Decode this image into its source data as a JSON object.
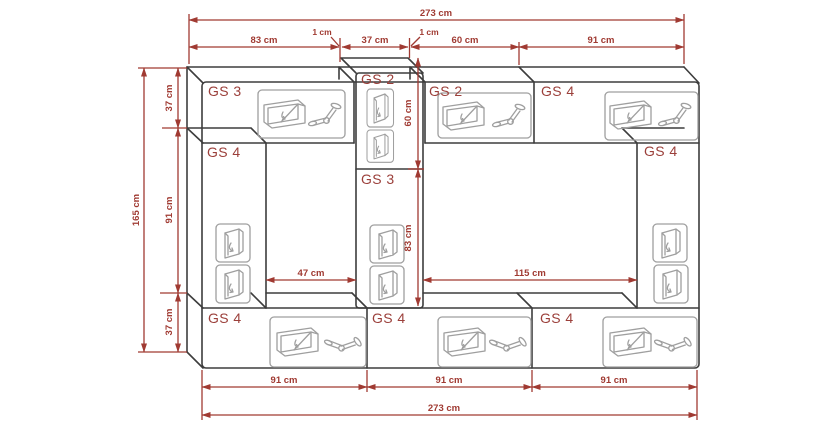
{
  "diagram": {
    "background": "#ffffff",
    "colors": {
      "outline": "#3d3d3d",
      "icon_line": "#9f9f9f",
      "dimension": "#a03a32",
      "label_text": "#9b3f3a"
    },
    "modules": {
      "top_left": "GS 3",
      "column_top": "GS 2",
      "top_middle": "GS 2",
      "top_right": "GS 4",
      "left_column": "GS 4",
      "column_middle": "GS 3",
      "right_column": "GS 4",
      "bottom_left": "GS 4",
      "bottom_middle": "GS 4",
      "bottom_right": "GS 4"
    },
    "dimensions": {
      "total_width_top": "273 cm",
      "total_width_bottom": "273 cm",
      "total_height": "165 cm",
      "top_segments": {
        "gs3_width": "83 cm",
        "gap_left": "1 cm",
        "column_width": "37 cm",
        "gap_right": "1 cm",
        "gs2_width": "60 cm",
        "gs4_width": "91 cm"
      },
      "left_sections": {
        "top_height": "37 cm",
        "middle_height": "91 cm",
        "bottom_height": "37 cm"
      },
      "column_sections": {
        "gs2_height": "60 cm",
        "gs3_height": "83 cm"
      },
      "openings": {
        "left_width": "47 cm",
        "right_width": "115 cm"
      },
      "bottom_segments": [
        "91 cm",
        "91 cm",
        "91 cm"
      ]
    }
  }
}
